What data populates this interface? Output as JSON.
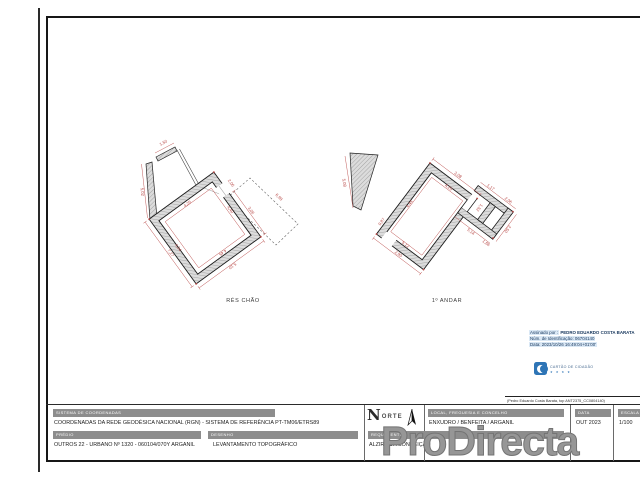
{
  "sheet": {
    "watermark": "ProDirecta"
  },
  "plans": [
    {
      "label": "RÉS CHÃO",
      "dims": [
        "1,50",
        "5,02",
        "2,06",
        "3,06",
        "4,40",
        "4,45",
        "4,34",
        "4,25",
        "7,27",
        "5,10",
        "6,98"
      ]
    },
    {
      "label": "1º ANDAR",
      "dims": [
        "3,08",
        "1,17",
        "2,06",
        "4,20",
        "4,44",
        "1,52",
        "5,14",
        "1,66",
        "2,50",
        "5,12",
        "2,90",
        "0,87",
        "5,08"
      ]
    }
  ],
  "signature": {
    "signed_by_label": "Assinado por :",
    "signed_by_name": "PEDRO EDUARDO COSTA BARATA",
    "id_line": "Núm. de Identificação: 06704140",
    "date_line": "Data: 2023/10/26 16:49:04+01'00'",
    "cc_label": "CARTÃO DE CIDADÃO",
    "cc_stars": "★ ★ ★ ★",
    "note": "(Pedro Eduardo Costa Barata, top ANT2375_CC0804140)"
  },
  "titleblock": {
    "sistema_header": "SISTEMA DE COORDENADAS",
    "sistema_value": "COORDENADAS DA REDE GEODÉSICA NACIONAL (RGN) - SISTEMA DE REFERÊNCIA PT-TM06/ETRS89",
    "predio_header": "PRÉDIO",
    "predio_value": "OUTROS 22 - URBANO Nº 1320 - 060104/070Y ARGANIL",
    "desenho_header": "DESENHO",
    "desenho_value": "LEVANTAMENTO TOPOGRÁFICO",
    "local_header": "LOCAL, FREGUESIA E CONCELHO",
    "local_value": "ENXUDRO / BENFEITA / ARGANIL",
    "data_header": "DATA",
    "data_value": "OUT 2023",
    "escala_header": "ESCALA",
    "escala_value": "1/100",
    "requerente_header": "REQUERENTE",
    "requerente_value": "ALZIRA DA CONCEIÇÃO",
    "logo_n": "N",
    "logo_orte": "ORTE"
  },
  "colors": {
    "dimension_red": "#b94a48",
    "wall_gray": "#dcdcdc",
    "titlebar_gray": "#8d8d8d",
    "cc_blue": "#2e75b6",
    "watermark_gray": "#969696",
    "signature_blue": "#16365c"
  }
}
